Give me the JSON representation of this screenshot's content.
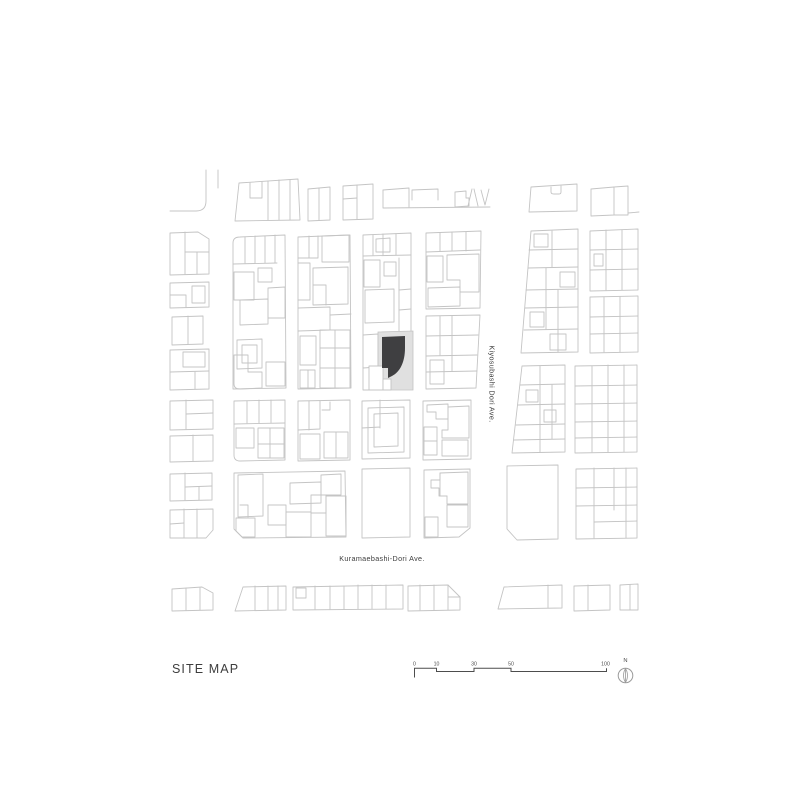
{
  "title": {
    "label": "SITE MAP"
  },
  "streets": {
    "vertical": "Kiyosubashi Dori Ave.",
    "horizontal": "Kuramaebashi-Dori Ave."
  },
  "scale_bar": {
    "unit_labels": [
      "0",
      "10",
      "30",
      "50",
      "100"
    ],
    "label_xs": [
      414.5,
      436.5,
      474,
      511,
      605.5
    ],
    "labels_y": 665.5,
    "path": "M414.5,677.5 L414.5,668.3 L436.5,668.3 L436.5,671.5 L474,671.5 L474,668.3 L511,668.3 L511,671.5 L606.5,671.5 L606.5,668.3"
  },
  "north": {
    "label": "N",
    "needle": "M625.5,668.8 C628.1,672.2 628.1,678.8 625.5,682.2 C622.9,678.8 622.9,672.2 625.5,668.8 Z",
    "axis": "M625.5,668.8 L625.5,682.2"
  },
  "colors": {
    "line": "#c4c4c4",
    "site_building": "#3f3f41",
    "site_lot": "#e0e0e0",
    "text": "#3d3d3d",
    "scale": "#4d4d4d",
    "north": "#9a9a9a"
  },
  "map": {
    "site": {
      "lot": "M378,332 L413,331 L413,390 L378,390 Z",
      "white_parcels": [
        "M369,366 L383,366 L383,390 L369,390 Z",
        "M383,379 L391,379 L391,390 L383,390 Z"
      ],
      "building": "M382,337 L405,336 L405,348 C405,362 400,372 392,376 L388,378 L388,368 L382,368 Z"
    },
    "linework": [
      "M206,170 L206,201 Q206,211 196,211 L170,211",
      "M218,170 L218,188",
      "M239,183 L298,179 L300,220 L235,221 Z",
      "M268,181 L268,220",
      "M279,180 L279,220",
      "M290,180 L290,220",
      "M250,183 L250,198 L262,198 L262,182",
      "M308,189 L330,187 L330,220 L308,221 Z",
      "M319,188 L319,220",
      "M343,186 L373,184 L373,219 L343,220 Z",
      "M357,185 L357,219",
      "M343,199 L357,198",
      "M383,190 L383,208 L490,207",
      "M383,190 L409,188 L409,207",
      "M412,200 L412,190 L438,189 L438,200",
      "M455,192 L466,191 L466,198 L469,198 L469,206 L455,207 Z",
      "M468,206 L472,189 M474,189 L478,206",
      "M481,190 L485,205 L489,189",
      "M531,187 L577,184 L577,211 L529,212 Z",
      "M551,187 L551,192 Q551,194 554,194 L559,194 Q561,194 561,192 L561,186",
      "M591,189 L614,187 L614,215 L591,216 Z",
      "M614,187 L628,186 L628,215 L614,215",
      "M628,213 L639,212",
      "M170,233 L198,232 L209,239 L209,274 L170,275 Z",
      "M185,232 L185,274",
      "M185,252 L209,252",
      "M197,252 L197,274",
      "M170,283 L209,282 L209,307 L170,308 Z",
      "M170,295 L186,295 L186,307",
      "M192,286 L205,286 L205,303 L192,303 Z",
      "M172,317 L203,316 L203,344 L172,345 Z",
      "M188,316 L188,344",
      "M170,350 L209,349 L209,389 L170,390 Z",
      "M183,352 L205,352 L205,367 L183,367 Z",
      "M170,372 L209,371",
      "M195,372 L195,389",
      "M233,243 Q233,237 240,237 L285,235 L286,388 L233,389 Z",
      "M233,264 L277,263",
      "M245,237 L245,263",
      "M255,236 L255,263",
      "M265,236 L265,263",
      "M275,235 L275,263",
      "M258,268 L272,268 L272,282 L258,282 Z",
      "M234,272 L254,272 L254,300 L234,300 Z",
      "M240,300 L268,299 L268,324 L240,325 Z",
      "M268,288 L285,287 L285,318 L268,318 Z",
      "M237,340 L262,339 L262,368 L237,369 Z",
      "M242,345 L257,345 L257,363 L242,363 Z",
      "M234,355 L248,355 L248,372 L262,372 L262,388 L240,389 Q234,389 234,384 Z",
      "M266,362 L285,362 L285,386 L266,386 Z",
      "M298,237 L350,235 L351,388 L298,389 Z",
      "M309,236 L309,258",
      "M298,258 L318,258 L318,236",
      "M322,236 L349,235 L349,262 L322,262 Z",
      "M298,263 L310,263 L310,300 L298,300",
      "M313,268 L348,267 L348,304 L313,305 Z",
      "M313,285 L326,285 L326,305",
      "M298,308 L330,307 L330,330 L298,331",
      "M330,315 L351,314",
      "M300,336 L316,336 L316,365 L300,365 Z",
      "M320,330 L350,330 L350,388 L320,388 Z",
      "M335,330 L335,388",
      "M320,348 L350,348",
      "M320,368 L350,368",
      "M300,370 L315,370 L315,388 L300,388 Z",
      "M308,370 L308,388",
      "M363,235 L411,233 L411,331 M363,235 L363,339",
      "M363,256 L411,255",
      "M373,235 L373,255",
      "M383,234 L383,255",
      "M396,234 L396,255",
      "M376,239 L390,238 L390,252 L376,252 Z",
      "M364,260 L380,260 L380,287 L364,287 Z",
      "M384,262 L396,262 L396,276 L384,276 Z",
      "M365,290 L394,289 L394,322 L365,323 Z",
      "M399,258 L399,332",
      "M399,290 L411,289",
      "M399,310 L411,309",
      "M363,335 L378,334 L378,367 L363,368 Z",
      "M363,367 L363,390 L378,390",
      "M426,233 L481,231 L480,308 L426,309 Z",
      "M426,252 L480,250",
      "M440,233 L440,251",
      "M452,232 L452,251",
      "M466,232 L466,251",
      "M427,256 L443,256 L443,282 L427,282 Z",
      "M447,255 L479,254 L479,292 L460,292 L460,280 L447,280 Z",
      "M428,288 L460,287 L460,306 L428,307 Z",
      "M426,316 L480,315 L476,388 L426,389 Z",
      "M426,336 L478,335",
      "M426,356 L477,355",
      "M426,372 L477,371",
      "M452,316 L452,371",
      "M440,316 L440,355",
      "M430,360 L444,360 L444,384 L430,384 Z",
      "M531,231 L578,229 L578,352 L521,353 Z",
      "M529,250 L578,249",
      "M528,268 L578,267",
      "M526,290 L578,289",
      "M525,308 L578,307",
      "M524,330 L578,329",
      "M552,231 L552,267",
      "M546,268 L546,329",
      "M558,290 L558,352",
      "M534,234 L548,234 L548,247 L534,247 Z",
      "M560,272 L575,272 L575,287 L560,287 Z",
      "M530,312 L544,312 L544,327 L530,327 Z",
      "M550,334 L566,334 L566,350 L550,350 Z",
      "M590,231 L638,229 L638,290 L590,291 Z",
      "M606,230 L606,290",
      "M622,230 L622,290",
      "M590,250 L638,249",
      "M590,270 L638,269",
      "M594,254 L603,254 L603,266 L594,266 Z",
      "M590,297 L638,296 L638,352 L590,353 Z",
      "M604,297 L604,352",
      "M620,297 L620,352",
      "M590,317 L638,316",
      "M590,334 L638,333",
      "M170,401 L213,400 L213,429 L170,430 Z",
      "M186,400 L186,429",
      "M186,414 L213,413",
      "M170,436 L213,435 L213,461 L170,462 Z",
      "M193,435 L193,461",
      "M234,401 L285,400 L285,460 L240,461 Q234,461 234,455 Z",
      "M234,424 L285,423",
      "M247,401 L247,423",
      "M259,400 L259,423",
      "M271,400 L271,423",
      "M236,428 L254,428 L254,448 L236,448 Z",
      "M258,428 L284,428 L284,458 L258,458 Z",
      "M270,428 L270,458",
      "M258,444 L284,444",
      "M298,401 L350,400 L350,460 L298,461 Z",
      "M309,401 L309,430 M298,430 L320,429 L320,401",
      "M322,410 L330,410 L330,402",
      "M300,434 L320,434 L320,459 L300,459 Z",
      "M324,432 L348,432 L348,458 L324,458 Z",
      "M336,432 L336,458",
      "M362,401 L410,400 L410,458 L362,459 Z",
      "M380,400 L380,428 M362,428 L380,427",
      "M368,408 L404,407 L404,452 L368,453 Z",
      "M374,414 L398,413 L398,446 L374,447 Z",
      "M423,401 L471,400 L471,459 L423,460 Z",
      "M427,405 L448,404 L448,419 L436,419 L436,412 L427,412 Z",
      "M448,407 L469,406 L469,438 L442,438 L442,430 L448,430 Z",
      "M424,427 L437,427 L437,455 L424,455 Z",
      "M424,441 L437,441",
      "M442,440 L468,440 L468,456 L442,456 Z",
      "M522,366 L565,365 L565,452 L512,453 Z",
      "M520,385 L565,384",
      "M518,405 L565,404",
      "M516,425 L565,424",
      "M514,440 L565,439",
      "M540,366 L540,452",
      "M552,385 L552,439",
      "M526,390 L538,390 L538,402 L526,402 Z",
      "M544,410 L556,410 L556,422 L544,422 Z",
      "M575,366 L637,365 L637,452 L575,453 Z",
      "M592,366 L592,452",
      "M608,365 L608,452",
      "M624,365 L624,452",
      "M575,386 L637,385",
      "M575,404 L637,403",
      "M575,422 L637,421",
      "M575,438 L637,437",
      "M170,474 L212,473 L212,500 L170,501 Z",
      "M185,473 L185,500",
      "M185,487 L212,486",
      "M199,487 L199,500",
      "M170,510 L213,509 L213,530 L206,538 L170,538 Z",
      "M184,509 L184,538",
      "M197,509 L197,538",
      "M170,524 L184,523",
      "M234,473 L345,471 L346,537 L243,538 L234,529 Z",
      "M238,475 L263,474 L263,516 L238,517 Z",
      "M240,505 L248,505 L248,517",
      "M290,483 L321,482 L321,503 L290,504 Z",
      "M321,475 L341,474 L341,495 L321,495 Z",
      "M311,495 L326,495 L326,513 L311,513 Z",
      "M268,505 L286,505 L286,525 L268,525 Z",
      "M286,512 L311,512 L311,537 L286,537 Z",
      "M326,496 L346,496 L346,536 L326,536 Z",
      "M236,518 L255,518 L255,537 L242,537 L236,531 Z",
      "M362,469 L410,468 L410,537 L362,538 Z",
      "M424,470 L470,469 L470,528 L459,537 L424,538 Z",
      "M440,473 L468,472 L468,504 L447,504 L447,496 L440,496 Z",
      "M447,496 L439,496 L439,488 L431,488 L431,480 L440,480 L440,473",
      "M447,505 L468,505 L468,527 L447,527 Z",
      "M425,517 L438,517 L438,537 L425,537 Z",
      "M507,466 L558,465 L558,539 L517,540 L507,529 Z",
      "M576,469 L637,468 L637,538 L576,539 Z",
      "M594,468 L594,538",
      "M614,468 L614,510",
      "M626,468 L626,538",
      "M576,488 L637,487",
      "M576,506 L637,505",
      "M594,522 L637,521",
      "M172,589 L202,587 L213,593 L213,610 L172,611 Z",
      "M186,588 L186,610",
      "M200,588 L200,610",
      "M243,587 L286,586 L286,610 L235,611 Z",
      "M255,586 L255,610",
      "M268,586 L268,610",
      "M278,586 L278,610",
      "M293,587 L403,585 L403,609 L293,610 Z",
      "M296,588 L306,588 L306,598 L296,598 Z",
      "M315,586 L315,609",
      "M330,586 L330,609",
      "M344,586 L344,609",
      "M358,585 L358,609",
      "M372,585 L372,609",
      "M386,585 L386,609",
      "M408,586 L448,585 L460,597 L460,610 L408,611 Z",
      "M420,585 L420,610",
      "M434,585 L434,610",
      "M448,585 L448,610 M448,597 L460,597",
      "M504,587 L562,585 L562,608 L498,609 Z",
      "M548,585 L548,608",
      "M574,586 L610,585 L610,610 L574,611 Z",
      "M588,585 L588,610",
      "M620,585 L638,584 L638,610 L620,610 Z",
      "M630,585 L630,610"
    ]
  }
}
